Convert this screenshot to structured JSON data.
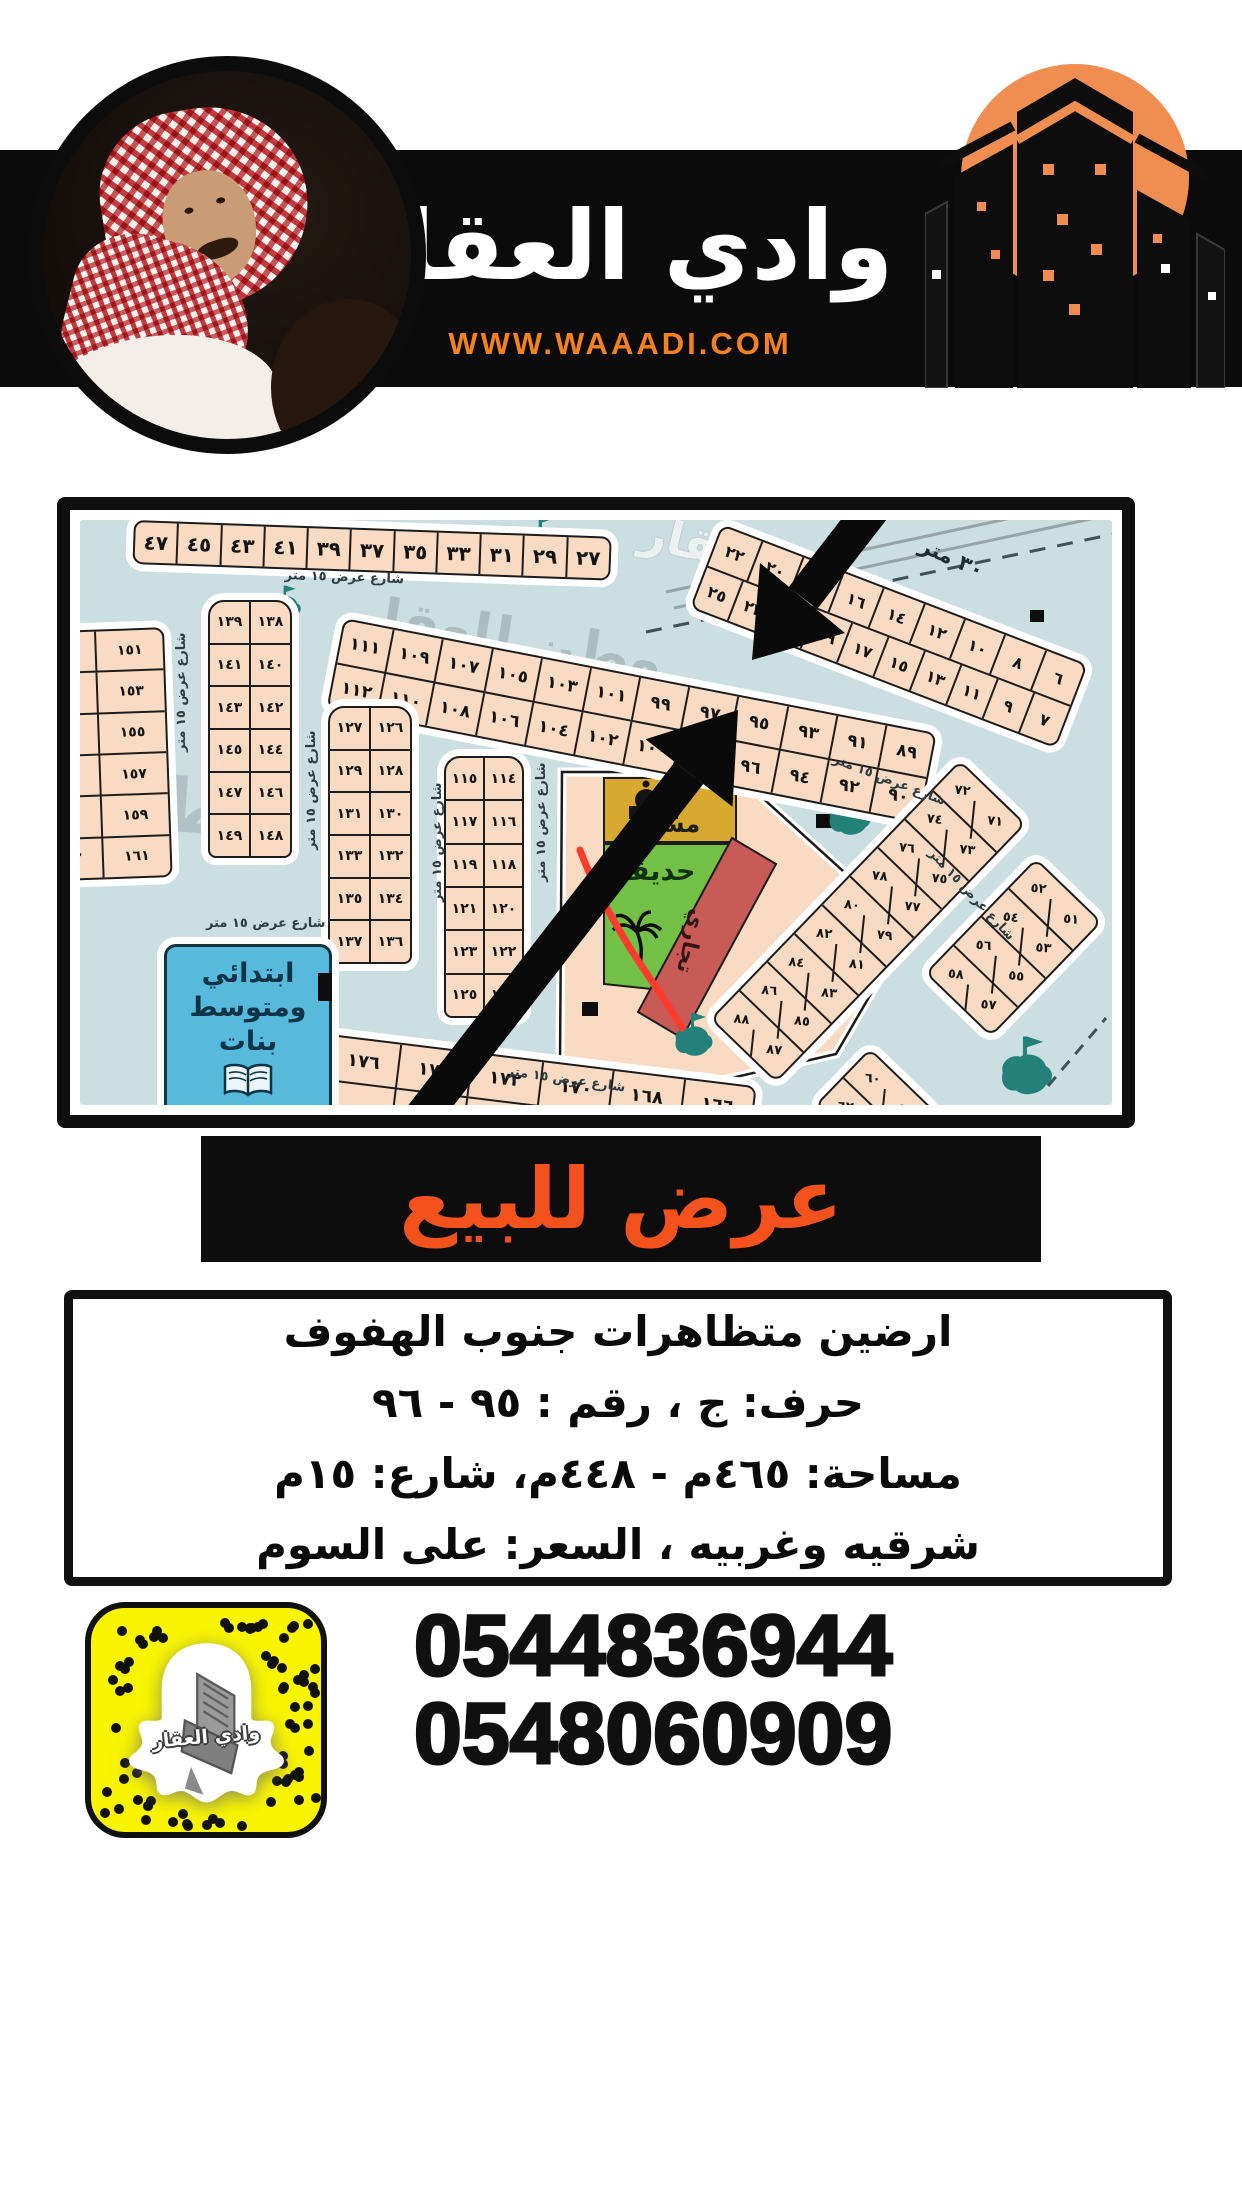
{
  "header": {
    "title": "وادي العقار",
    "website": "WWW.WAAADI.COM"
  },
  "sale_banner": {
    "text": "عرض للبيع"
  },
  "details": {
    "line1": "ارضين متظاهرات جنوب الهفوف",
    "line2": "حرف: ج ، رقم : ٩٥ - ٩٦",
    "line3": "مساحة: ٤٦٥م - ٤٤٨م، شارع: ١٥م",
    "line4": "شرقيه وغربيه ، السعر: على السوم"
  },
  "contact": {
    "phone1": "0544836944",
    "phone2": "0548060909",
    "snapcode_label": "وادي العقار"
  },
  "map": {
    "labels": {
      "school_line1": "ابتدائي",
      "school_line2": "ومتوسط",
      "school_line3": "بنات",
      "mosque": "مسجد",
      "park": "حديقة",
      "commercial": "تجاري",
      "street": "شارع عرض ١٥ متر",
      "road": "٣٠ متر",
      "watermark": "وطن للعقار",
      "watermark_part": "للعقار",
      "watermark_short": "وطن"
    },
    "rows": {
      "top_left": [
        "٤٧",
        "٤٥",
        "٤٣",
        "٤١",
        "٣٩",
        "٣٧",
        "٣٥",
        "٣٣",
        "٣١",
        "٢٩",
        "٢٧"
      ],
      "top_right": [
        [
          "٢٢",
          "٢٠",
          "١٨",
          "١٦",
          "١٤",
          "١٢",
          "١٠",
          "٨",
          "٦"
        ],
        [
          "٢٥",
          "٢٣",
          "٢١",
          "١٩",
          "١٧",
          "١٥",
          "١٣",
          "١١",
          "٩",
          "٧"
        ]
      ],
      "arc": [
        [
          "١١١",
          "١٠٩",
          "١٠٧",
          "١٠٥",
          "١٠٣",
          "١٠١",
          "٩٩",
          "٩٧",
          "٩٥",
          "٩٣",
          "٩١",
          "٨٩"
        ],
        [
          "١١٢",
          "١١٠",
          "١٠٨",
          "١٠٦",
          "١٠٤",
          "١٠٢",
          "١٠٠",
          "٩٨",
          "٩٦",
          "٩٤",
          "٩٢",
          "٩٠"
        ]
      ],
      "col_151": [
        [
          "١٥٢",
          "١٥١"
        ],
        [
          "١٥٤",
          "١٥٣"
        ],
        [
          "١٥٦",
          "١٥٥"
        ],
        [
          "١٥٨",
          "١٥٧"
        ],
        [
          "١٦٠",
          "١٥٩"
        ],
        [
          "١٦٢",
          "١٦١"
        ]
      ],
      "col_138": [
        [
          "١٣٩",
          "١٣٨"
        ],
        [
          "١٤١",
          "١٤٠"
        ],
        [
          "١٤٣",
          "١٤٢"
        ],
        [
          "١٤٥",
          "١٤٤"
        ],
        [
          "١٤٧",
          "١٤٦"
        ],
        [
          "١٤٩",
          "١٤٨"
        ]
      ],
      "col_126": [
        [
          "١٢٧",
          "١٢٦"
        ],
        [
          "١٢٩",
          "١٢٨"
        ],
        [
          "١٣١",
          "١٣٠"
        ],
        [
          "١٣٣",
          "١٣٢"
        ],
        [
          "١٣٥",
          "١٣٤"
        ],
        [
          "١٣٧",
          "١٣٦"
        ]
      ],
      "col_114": [
        [
          "١١٥",
          "١١٤"
        ],
        [
          "١١٧",
          "١١٦"
        ],
        [
          "١١٩",
          "١١٨"
        ],
        [
          "١٢١",
          "١٢٠"
        ],
        [
          "١٢٣",
          "١٢٢"
        ],
        [
          "١٢٥",
          "١٢٤"
        ]
      ],
      "bottom": [
        [
          "١٧٦",
          "١٧٤",
          "١٧٢",
          "١٧٠",
          "١٦٨",
          "١٦٦"
        ],
        [
          "",
          "١٧٥",
          "١٧٣",
          "١٧١",
          "",
          ""
        ]
      ],
      "diam_71": [
        [
          "٧٢",
          "٧١"
        ],
        [
          "٧٤",
          "٧٣"
        ],
        [
          "٧٦",
          "٧٥"
        ],
        [
          "٧٨",
          "٧٧"
        ],
        [
          "٨٠",
          "٧٩"
        ],
        [
          "٨٢",
          "٨١"
        ],
        [
          "٨٤",
          "٨٣"
        ],
        [
          "٨٦",
          "٨٥"
        ],
        [
          "٨٨",
          "٨٧"
        ]
      ],
      "diam_52": [
        [
          "٥٢",
          "٥١"
        ],
        [
          "٥٤",
          "٥٣"
        ],
        [
          "٥٦",
          "٥٥"
        ],
        [
          "٥٨",
          "٥٧"
        ]
      ],
      "diam_59": [
        [
          "٦٠",
          "٥٩"
        ],
        [
          "٦٢",
          "٦١"
        ]
      ]
    }
  },
  "colors": {
    "accent_orange": "#EF8E50",
    "website_orange": "#F5821F",
    "sale_orange": "#F4521D",
    "map_water": "#CBDEE2",
    "plot_peach": "#F9DBC3",
    "park_green": "#72C045",
    "mosque_gold": "#D8A930",
    "commercial_red": "#C95B57",
    "school_blue": "#57B9DB",
    "snap_yellow": "#F9F500"
  }
}
